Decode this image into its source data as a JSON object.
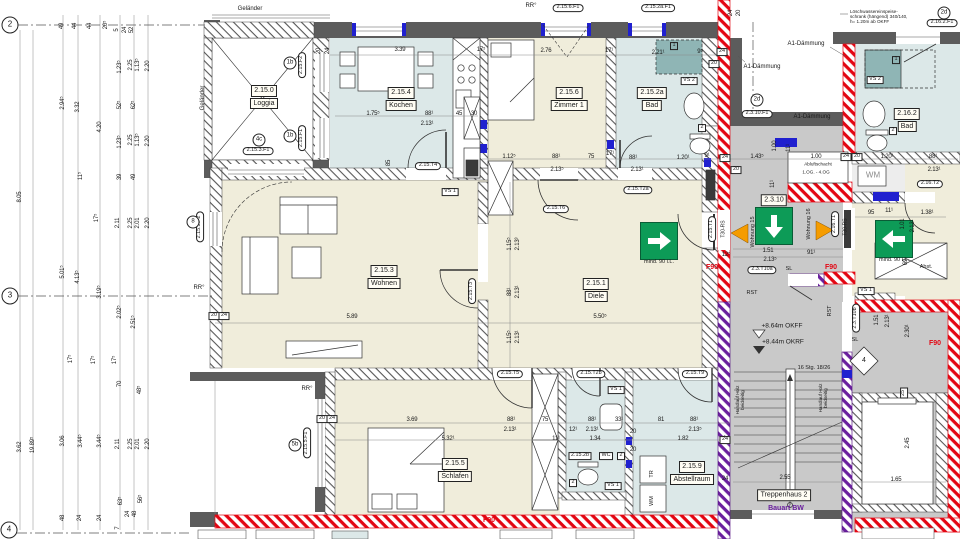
{
  "colors": {
    "beige": "#f0eddb",
    "lightblue": "#dce8e8",
    "teal": "#8fb5b5",
    "corridor_gray": "#c9c9c9",
    "wall_dark": "#5c5c5c",
    "f90_red": "#e30613",
    "bw_purple": "#6a1f9e",
    "exit_green": "#0d9b57",
    "marker_blue": "#2020cf",
    "door_orange": "#f59c00"
  },
  "room_labels": [
    {
      "x": 264,
      "y": 97,
      "lines": [
        "2.15.0",
        "Loggia"
      ]
    },
    {
      "x": 401,
      "y": 99,
      "lines": [
        "2.15.4",
        "Kochen"
      ]
    },
    {
      "x": 569,
      "y": 99,
      "lines": [
        "2.15.6",
        "Zimmer 1"
      ]
    },
    {
      "x": 652,
      "y": 99,
      "lines": [
        "2.15.2a",
        "Bad"
      ]
    },
    {
      "x": 907,
      "y": 120,
      "lines": [
        "2.16.2",
        "Bad"
      ]
    },
    {
      "x": 384,
      "y": 277,
      "lines": [
        "2.15.3",
        "Wohnen"
      ]
    },
    {
      "x": 596,
      "y": 290,
      "lines": [
        "2.15.1",
        "Diele"
      ]
    },
    {
      "x": 455,
      "y": 470,
      "lines": [
        "2.15.5",
        "Schlafen"
      ]
    },
    {
      "x": 692,
      "y": 473,
      "lines": [
        "2.15.9",
        "Abstellraum"
      ]
    },
    {
      "x": 774,
      "y": 200,
      "lines": [
        "2.3.10"
      ]
    },
    {
      "x": 784,
      "y": 495,
      "lines": [
        "Treppenhaus 2"
      ]
    }
  ],
  "box_labels": [
    {
      "x": 450,
      "y": 192,
      "t": "VS 1"
    },
    {
      "x": 689,
      "y": 81,
      "t": "VS 2"
    },
    {
      "x": 875,
      "y": 80,
      "t": "VS 2"
    },
    {
      "x": 616,
      "y": 390,
      "t": "VS 1"
    },
    {
      "x": 613,
      "y": 486,
      "t": "VS 1"
    },
    {
      "x": 866,
      "y": 291,
      "t": "VS 1"
    },
    {
      "x": 580,
      "y": 456,
      "t": "2.15.2b"
    },
    {
      "x": 606,
      "y": 456,
      "t": "WC"
    },
    {
      "x": 621,
      "y": 456,
      "t": "2"
    },
    {
      "x": 573,
      "y": 483,
      "t": "2"
    },
    {
      "x": 702,
      "y": 128,
      "t": "2"
    },
    {
      "x": 893,
      "y": 131,
      "t": "2"
    },
    {
      "x": 674,
      "y": 46,
      "t": "1",
      "teal": true
    },
    {
      "x": 896,
      "y": 60,
      "t": "1",
      "teal": true
    },
    {
      "x": 214,
      "y": 316,
      "t": "20"
    },
    {
      "x": 224,
      "y": 316,
      "t": "24"
    },
    {
      "x": 322,
      "y": 419,
      "t": "20"
    },
    {
      "x": 332,
      "y": 419,
      "t": "24"
    },
    {
      "x": 725,
      "y": 158,
      "t": "24"
    },
    {
      "x": 736,
      "y": 170,
      "t": "20"
    },
    {
      "x": 846,
      "y": 157,
      "t": "24"
    },
    {
      "x": 857,
      "y": 157,
      "t": "20"
    },
    {
      "x": 722,
      "y": 52,
      "t": "24"
    },
    {
      "x": 714,
      "y": 64,
      "t": "20"
    },
    {
      "x": 725,
      "y": 440,
      "t": "24"
    },
    {
      "x": 904,
      "y": 393,
      "t": "25",
      "r": -90
    }
  ],
  "oval_tags": [
    {
      "x": 302,
      "y": 65,
      "t": "2.15.F2",
      "r": -90
    },
    {
      "x": 302,
      "y": 138,
      "t": "2.15.F1",
      "r": -90
    },
    {
      "x": 258,
      "y": 151,
      "t": "2.15.3.F1"
    },
    {
      "x": 200,
      "y": 227,
      "t": "2.15.3.F2",
      "r": -90
    },
    {
      "x": 307,
      "y": 443,
      "t": "2.15.5.F1",
      "r": -90
    },
    {
      "x": 568,
      "y": 8,
      "t": "2.15.6.F1"
    },
    {
      "x": 658,
      "y": 8,
      "t": "2.15.2a.F1"
    },
    {
      "x": 757,
      "y": 114,
      "t": "2.3.10.F1"
    },
    {
      "x": 942,
      "y": 23,
      "t": "2.16.2.F1"
    },
    {
      "x": 428,
      "y": 166,
      "t": "2.15.T4"
    },
    {
      "x": 556,
      "y": 209,
      "t": "2.15.T6"
    },
    {
      "x": 638,
      "y": 190,
      "t": "2.15.T2a"
    },
    {
      "x": 472,
      "y": 291,
      "t": "2.15.T3",
      "r": -90
    },
    {
      "x": 712,
      "y": 229,
      "t": "2.15.T1",
      "r": -90
    },
    {
      "x": 510,
      "y": 374,
      "t": "2.15.T5"
    },
    {
      "x": 591,
      "y": 374,
      "t": "2.15.T2b"
    },
    {
      "x": 695,
      "y": 374,
      "t": "2.15.T9"
    },
    {
      "x": 762,
      "y": 270,
      "t": "2.3.T10a"
    },
    {
      "x": 856,
      "y": 318,
      "t": "2.3.T10b",
      "r": -90
    },
    {
      "x": 835,
      "y": 224,
      "t": "2.16.T1",
      "r": -90
    },
    {
      "x": 930,
      "y": 184,
      "t": "2.16.T2"
    }
  ],
  "circle_tags": [
    {
      "x": 10,
      "y": 25,
      "t": "2",
      "big": true
    },
    {
      "x": 10,
      "y": 296,
      "t": "3",
      "big": true
    },
    {
      "x": 9,
      "y": 530,
      "t": "4",
      "big": true
    },
    {
      "x": 290,
      "y": 63,
      "t": "1b"
    },
    {
      "x": 290,
      "y": 136,
      "t": "1b"
    },
    {
      "x": 259,
      "y": 140,
      "t": "4c"
    },
    {
      "x": 193,
      "y": 222,
      "t": "8"
    },
    {
      "x": 295,
      "y": 445,
      "t": "5b"
    },
    {
      "x": 757,
      "y": 100,
      "t": "2d"
    },
    {
      "x": 944,
      "y": 13,
      "t": "2d"
    }
  ],
  "dims": [
    {
      "x": 400,
      "y": 50,
      "t": "3.39"
    },
    {
      "x": 481,
      "y": 50,
      "t": "17⁵"
    },
    {
      "x": 546,
      "y": 51,
      "t": "2.76"
    },
    {
      "x": 609,
      "y": 51,
      "t": "17¹"
    },
    {
      "x": 658,
      "y": 53,
      "t": "2.21¹"
    },
    {
      "x": 700,
      "y": 52,
      "t": "9⁵"
    },
    {
      "x": 373,
      "y": 114,
      "t": "1.75⁵"
    },
    {
      "x": 429,
      "y": 114,
      "t": "88¹"
    },
    {
      "x": 459,
      "y": 114,
      "t": "45"
    },
    {
      "x": 474,
      "y": 114,
      "t": "30"
    },
    {
      "x": 427,
      "y": 124,
      "t": "2.13¹"
    },
    {
      "x": 389,
      "y": 163,
      "t": "85",
      "r": -90
    },
    {
      "x": 509,
      "y": 157,
      "t": "1.12⁵"
    },
    {
      "x": 556,
      "y": 157,
      "t": "88¹"
    },
    {
      "x": 591,
      "y": 157,
      "t": "75"
    },
    {
      "x": 610,
      "y": 154,
      "t": "17¹"
    },
    {
      "x": 557,
      "y": 170,
      "t": "2.13⁵"
    },
    {
      "x": 633,
      "y": 158,
      "t": "88¹"
    },
    {
      "x": 683,
      "y": 158,
      "t": "1.20¹"
    },
    {
      "x": 707,
      "y": 156,
      "t": "9¹"
    },
    {
      "x": 637,
      "y": 170,
      "t": "2.13¹"
    },
    {
      "x": 757,
      "y": 157,
      "t": "1.43⁵"
    },
    {
      "x": 816,
      "y": 157,
      "t": "1.00"
    },
    {
      "x": 887,
      "y": 157,
      "t": "1.20¹"
    },
    {
      "x": 933,
      "y": 157,
      "t": "88¹"
    },
    {
      "x": 934,
      "y": 170,
      "t": "2.13¹"
    },
    {
      "x": 775,
      "y": 146,
      "t": "1.00",
      "r": -90
    },
    {
      "x": 789,
      "y": 148,
      "t": "11¹",
      "r": -90
    },
    {
      "x": 726,
      "y": 255,
      "t": "12⁵"
    },
    {
      "x": 768,
      "y": 251,
      "t": "1.51"
    },
    {
      "x": 811,
      "y": 253,
      "t": "91¹"
    },
    {
      "x": 770,
      "y": 260,
      "t": "2.13⁵"
    },
    {
      "x": 773,
      "y": 184,
      "t": "11¹",
      "r": -90
    },
    {
      "x": 871,
      "y": 213,
      "t": "95"
    },
    {
      "x": 889,
      "y": 211,
      "t": "11¹"
    },
    {
      "x": 927,
      "y": 213,
      "t": "1.38¹"
    },
    {
      "x": 903,
      "y": 224,
      "t": "1.01",
      "r": -90
    },
    {
      "x": 913,
      "y": 226,
      "t": "2.13¹",
      "r": -90
    },
    {
      "x": 906,
      "y": 262,
      "t": "69",
      "r": -90
    },
    {
      "x": 877,
      "y": 320,
      "t": "1.51",
      "r": -90
    },
    {
      "x": 888,
      "y": 321,
      "t": "2.13¹",
      "r": -90
    },
    {
      "x": 908,
      "y": 331,
      "t": "2.30¹",
      "r": -90
    },
    {
      "x": 785,
      "y": 478,
      "t": "2.55"
    },
    {
      "x": 896,
      "y": 480,
      "t": "1.65"
    },
    {
      "x": 908,
      "y": 443,
      "t": "2.45",
      "r": -90
    },
    {
      "x": 352,
      "y": 317,
      "t": "5.89"
    },
    {
      "x": 600,
      "y": 317,
      "t": "5.50⁵"
    },
    {
      "x": 510,
      "y": 244,
      "t": "1.15⁵",
      "r": -90
    },
    {
      "x": 518,
      "y": 244,
      "t": "2.13³",
      "r": -90
    },
    {
      "x": 510,
      "y": 292,
      "t": "88¹",
      "r": -90
    },
    {
      "x": 518,
      "y": 292,
      "t": "2.13¹",
      "r": -90
    },
    {
      "x": 510,
      "y": 337,
      "t": "1.15⁵",
      "r": -90
    },
    {
      "x": 518,
      "y": 337,
      "t": "2.13¹",
      "r": -90
    },
    {
      "x": 412,
      "y": 420,
      "t": "3.69"
    },
    {
      "x": 511,
      "y": 420,
      "t": "88¹"
    },
    {
      "x": 545,
      "y": 420,
      "t": "75"
    },
    {
      "x": 510,
      "y": 430,
      "t": "2.13¹"
    },
    {
      "x": 448,
      "y": 439,
      "t": "5.32¹"
    },
    {
      "x": 556,
      "y": 439,
      "t": "11¹"
    },
    {
      "x": 592,
      "y": 420,
      "t": "88¹"
    },
    {
      "x": 619,
      "y": 420,
      "t": "33¹"
    },
    {
      "x": 661,
      "y": 420,
      "t": "81"
    },
    {
      "x": 694,
      "y": 420,
      "t": "88¹"
    },
    {
      "x": 573,
      "y": 430,
      "t": "12¹"
    },
    {
      "x": 592,
      "y": 430,
      "t": "2.13¹"
    },
    {
      "x": 695,
      "y": 430,
      "t": "2.13⁵"
    },
    {
      "x": 595,
      "y": 439,
      "t": "1.34"
    },
    {
      "x": 683,
      "y": 439,
      "t": "1.82"
    },
    {
      "x": 633,
      "y": 432,
      "t": "20"
    },
    {
      "x": 726,
      "y": 439,
      "t": "24"
    },
    {
      "x": 633,
      "y": 450,
      "t": "20"
    },
    {
      "x": 725,
      "y": 479,
      "t": "24"
    },
    {
      "x": 20,
      "y": 197,
      "t": "8.05",
      "r": -90
    },
    {
      "x": 20,
      "y": 447,
      "t": "3.62",
      "r": -90
    },
    {
      "x": 33,
      "y": 445,
      "t": "19.89⁵",
      "r": -90
    },
    {
      "x": 63,
      "y": 103,
      "t": "2.94⁵",
      "r": -90
    },
    {
      "x": 78,
      "y": 107,
      "t": "3.32",
      "r": -90
    },
    {
      "x": 100,
      "y": 127,
      "t": "4.20",
      "r": -90
    },
    {
      "x": 81,
      "y": 176,
      "t": "11⁵",
      "r": -90
    },
    {
      "x": 97,
      "y": 218,
      "t": "17⁵",
      "r": -90
    },
    {
      "x": 63,
      "y": 272,
      "t": "5.01⁵",
      "r": -90
    },
    {
      "x": 78,
      "y": 277,
      "t": "4.13⁵",
      "r": -90
    },
    {
      "x": 100,
      "y": 292,
      "t": "3.19⁵",
      "r": -90
    },
    {
      "x": 120,
      "y": 67,
      "t": "1.23⁵",
      "r": -90
    },
    {
      "x": 131,
      "y": 65,
      "t": "2.25",
      "r": -90
    },
    {
      "x": 138,
      "y": 65,
      "t": "1.13⁵",
      "r": -90
    },
    {
      "x": 148,
      "y": 66,
      "t": "2.20",
      "r": -90
    },
    {
      "x": 120,
      "y": 105,
      "t": "52⁵",
      "r": -90
    },
    {
      "x": 134,
      "y": 105,
      "t": "62⁵",
      "r": -90
    },
    {
      "x": 120,
      "y": 142,
      "t": "1.23⁵",
      "r": -90
    },
    {
      "x": 131,
      "y": 140,
      "t": "2.25",
      "r": -90
    },
    {
      "x": 138,
      "y": 140,
      "t": "1.13⁵",
      "r": -90
    },
    {
      "x": 148,
      "y": 141,
      "t": "2.20",
      "r": -90
    },
    {
      "x": 120,
      "y": 177,
      "t": "39",
      "r": -90
    },
    {
      "x": 134,
      "y": 177,
      "t": "49",
      "r": -90
    },
    {
      "x": 118,
      "y": 223,
      "t": "2.11",
      "r": -90
    },
    {
      "x": 131,
      "y": 223,
      "t": "2.25",
      "r": -90
    },
    {
      "x": 138,
      "y": 223,
      "t": "2.01",
      "r": -90
    },
    {
      "x": 148,
      "y": 223,
      "t": "2.20",
      "r": -90
    },
    {
      "x": 120,
      "y": 312,
      "t": "2.02⁵",
      "r": -90
    },
    {
      "x": 134,
      "y": 322,
      "t": "2.51⁵",
      "r": -90
    },
    {
      "x": 71,
      "y": 359,
      "t": "17⁵",
      "r": -90
    },
    {
      "x": 94,
      "y": 360,
      "t": "17⁵",
      "r": -90
    },
    {
      "x": 115,
      "y": 360,
      "t": "17⁵",
      "r": -90
    },
    {
      "x": 120,
      "y": 384,
      "t": "70",
      "r": -90
    },
    {
      "x": 140,
      "y": 390,
      "t": "48⁵",
      "r": -90
    },
    {
      "x": 63,
      "y": 441,
      "t": "3.06",
      "r": -90
    },
    {
      "x": 81,
      "y": 441,
      "t": "3.44⁵",
      "r": -90
    },
    {
      "x": 100,
      "y": 441,
      "t": "3.44⁵",
      "r": -90
    },
    {
      "x": 118,
      "y": 444,
      "t": "2.11",
      "r": -90
    },
    {
      "x": 131,
      "y": 444,
      "t": "2.25",
      "r": -90
    },
    {
      "x": 138,
      "y": 444,
      "t": "2.01",
      "r": -90
    },
    {
      "x": 148,
      "y": 444,
      "t": "2.20",
      "r": -90
    },
    {
      "x": 121,
      "y": 501,
      "t": "63⁵",
      "r": -90
    },
    {
      "x": 141,
      "y": 499,
      "t": "56⁵",
      "r": -90
    },
    {
      "x": 63,
      "y": 518,
      "t": "48",
      "r": -90
    },
    {
      "x": 80,
      "y": 518,
      "t": "24",
      "r": -90
    },
    {
      "x": 100,
      "y": 518,
      "t": "24",
      "r": -90
    },
    {
      "x": 128,
      "y": 514,
      "t": "24",
      "r": -90
    },
    {
      "x": 135,
      "y": 514,
      "t": "48",
      "r": -90
    },
    {
      "x": 118,
      "y": 528,
      "t": "7",
      "r": -90
    },
    {
      "x": 62,
      "y": 26,
      "t": "49",
      "r": -90
    },
    {
      "x": 75,
      "y": 26,
      "t": "44",
      "r": -90
    },
    {
      "x": 90,
      "y": 26,
      "t": "44",
      "r": -90
    },
    {
      "x": 106,
      "y": 25,
      "t": "20⁵",
      "r": -90
    },
    {
      "x": 117,
      "y": 30,
      "t": "5",
      "r": -90
    },
    {
      "x": 125,
      "y": 30,
      "t": "24",
      "r": -90
    },
    {
      "x": 132,
      "y": 30,
      "t": "52",
      "r": -90
    },
    {
      "x": 319,
      "y": 51,
      "t": "20",
      "r": -90
    },
    {
      "x": 328,
      "y": 51,
      "t": "24",
      "r": -90
    },
    {
      "x": 731,
      "y": 13,
      "t": "24",
      "r": -90
    },
    {
      "x": 739,
      "y": 13,
      "t": "20",
      "r": -90
    }
  ],
  "notes": [
    {
      "x": 250,
      "y": 9,
      "t": "Geländer"
    },
    {
      "x": 203,
      "y": 98,
      "t": "Geländer",
      "r": -90
    },
    {
      "x": 531,
      "y": 6,
      "t": "RR°"
    },
    {
      "x": 199,
      "y": 288,
      "t": "RR°"
    },
    {
      "x": 307,
      "y": 389,
      "t": "RR°"
    },
    {
      "x": 850,
      "y": 10,
      "t": "Löschwassereinspeise-\nschrank (hängend) 340/140,\nh= 1.20m ab OKFF",
      "s": 4.6,
      "tl": true
    },
    {
      "x": 806,
      "y": 44,
      "t": "A1-Dämmung"
    },
    {
      "x": 762,
      "y": 67,
      "t": "A1-Dämmung"
    },
    {
      "x": 812,
      "y": 117,
      "t": "A1-Dämmung"
    },
    {
      "x": 818,
      "y": 165,
      "t": "Abluftschacht",
      "s": 4.6
    },
    {
      "x": 816,
      "y": 173,
      "t": "1.OG. - 4.OG",
      "s": 4.6
    },
    {
      "x": 782,
      "y": 326,
      "t": "+8.64m OKFF",
      "s": 6.5
    },
    {
      "x": 783,
      "y": 342,
      "t": "+8.44m OKRF",
      "s": 6.5
    },
    {
      "x": 814,
      "y": 369,
      "t": "16 Stg. 18/26",
      "s": 5.5
    },
    {
      "x": 741,
      "y": 400,
      "t": "Handlauf  Holz\nbeidseitig",
      "r": -90,
      "s": 4.6
    },
    {
      "x": 824,
      "y": 398,
      "t": "Handlauf  Holz\nbeidseitig",
      "r": -90,
      "s": 4.6
    },
    {
      "x": 659,
      "y": 263,
      "t": "mind. 90 i.L.",
      "s": 5.5
    },
    {
      "x": 894,
      "y": 261,
      "t": "mind. 90 i.L.",
      "s": 5.5
    },
    {
      "x": 712,
      "y": 268,
      "t": "F90",
      "c": "#e30613",
      "w": "bold",
      "s": 7
    },
    {
      "x": 831,
      "y": 268,
      "t": "F90",
      "c": "#e30613",
      "w": "bold",
      "s": 7
    },
    {
      "x": 935,
      "y": 344,
      "t": "F90",
      "c": "#e30613",
      "w": "bold",
      "s": 7
    },
    {
      "x": 489,
      "y": 521,
      "t": "F90",
      "c": "#e30613",
      "w": "bold",
      "s": 7
    },
    {
      "x": 786,
      "y": 509,
      "t": "Bauart BW",
      "c": "#6a1f9e",
      "w": "bold",
      "s": 7
    },
    {
      "x": 752,
      "y": 294,
      "t": "RST",
      "s": 5.5
    },
    {
      "x": 831,
      "y": 311,
      "t": "RST",
      "r": -90,
      "s": 5.5
    },
    {
      "x": 789,
      "y": 270,
      "t": "SL",
      "s": 5.5
    },
    {
      "x": 855,
      "y": 341,
      "t": "SL",
      "s": 5.5
    },
    {
      "x": 754,
      "y": 232,
      "t": "Wohnung 15",
      "r": -90,
      "s": 5.5
    },
    {
      "x": 810,
      "y": 224,
      "t": "Wohnung 16",
      "r": -90,
      "s": 5.5
    },
    {
      "x": 724,
      "y": 229,
      "t": "T30-RS",
      "r": -90,
      "s": 5
    },
    {
      "x": 846,
      "y": 227,
      "t": "T30-RS",
      "r": -90,
      "s": 5
    },
    {
      "x": 653,
      "y": 474,
      "t": "TR",
      "r": -90,
      "s": 5.5
    },
    {
      "x": 653,
      "y": 501,
      "t": "WM",
      "r": -90,
      "s": 5.5
    },
    {
      "x": 926,
      "y": 268,
      "t": "Abst.",
      "s": 5.5
    },
    {
      "x": 873,
      "y": 176,
      "t": "WM",
      "s": 8,
      "c": "#8a8a8a"
    },
    {
      "x": 864,
      "y": 361,
      "t": "4",
      "s": 7
    }
  ]
}
